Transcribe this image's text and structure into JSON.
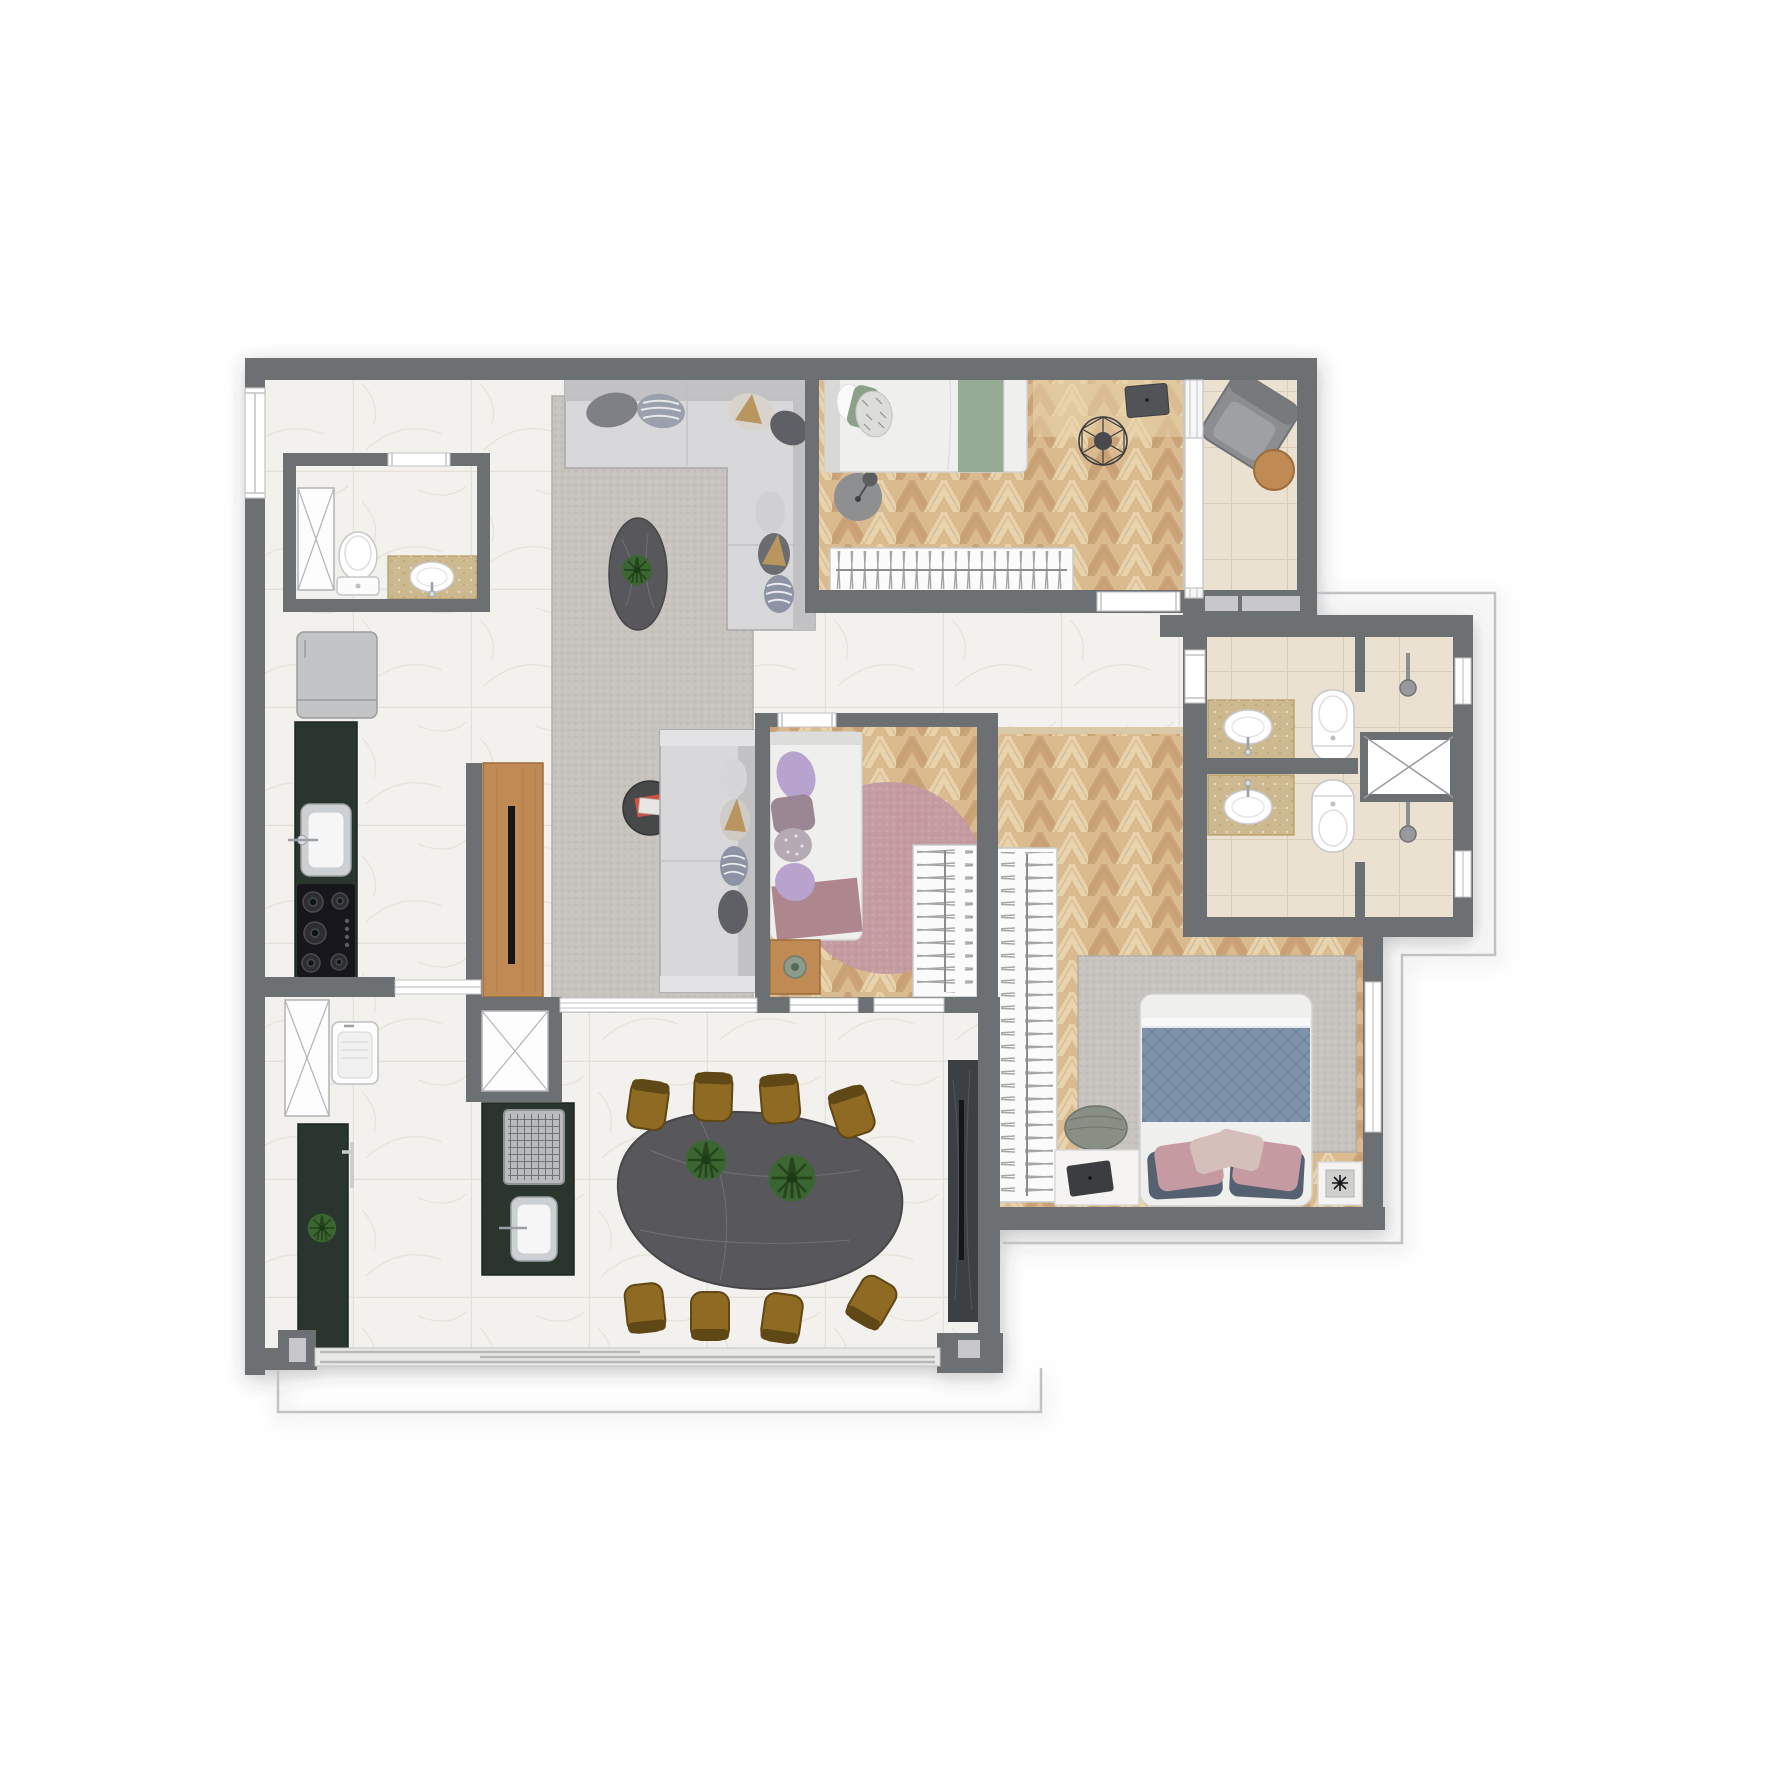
{
  "meta": {
    "title": "apartment-floor-plan",
    "kind": "architectural top-view render, no text labels",
    "background": "#ffffff"
  },
  "palette": {
    "wall": "#6d6f72",
    "wall_light": "#c7c7c9",
    "frame": "#c2c2c4",
    "marble": "#f3f1ed",
    "marble_line": "#e4dfd8",
    "wood": "#d9bb8f",
    "wood_dark": "#cba377",
    "wood_light": "#e8d3ac",
    "wood_seam": "#b8906a",
    "tile": "#ebe1d0",
    "tile_line": "#d9cdb7",
    "rug": "#c7c3be",
    "rug_edge": "#b2aea8",
    "sofa": "#d8d8da",
    "sofa_back": "#c2c2c5",
    "sofa_line": "#a8a8ab",
    "counter_green": "#2c362f",
    "counter_green_dark": "#1d2620",
    "steel": "#ccd0d2",
    "steel_dark": "#9aa0a3",
    "stone": "#58595b",
    "stone_line": "#707174",
    "gold": "#8e6b20",
    "gold_dark": "#5f4716",
    "plant": "#3b6631",
    "plant_dark": "#25451d",
    "bed_white": "#efefee",
    "bed_line": "#d2d2d0",
    "sage": "#95ab93",
    "quilt_blue": "#7e93a9",
    "quilt_line": "#5f7690",
    "navy": "#55616f",
    "pink": "#c59ba1",
    "blush": "#d4bfba",
    "pink_rug": "#c49aa2",
    "lilac": "#b7a3cd",
    "mauve": "#9b8793",
    "wood_furniture": "#c08a55",
    "wood_furniture_dark": "#9d6c38",
    "panel_dark": "#3c3f42",
    "tv_black": "#141517",
    "vanity_stone": "#cdb990",
    "vanity_stone_dark": "#b39a60",
    "chair_gray": "#8b8d90",
    "chair_gray_dark": "#6f7173",
    "wire": "#3a3b3d",
    "white": "#ffffff"
  },
  "rooms": [
    {
      "id": "entry-hall",
      "floor": "marble",
      "furniture": [
        "entry-door"
      ]
    },
    {
      "id": "guest-bathroom",
      "floor": "marble",
      "furniture": [
        "toilet",
        "vanity-sink",
        "shaft-closet"
      ]
    },
    {
      "id": "kitchen",
      "floor": "marble",
      "furniture": [
        "refrigerator",
        "green-counter",
        "kitchen-sink",
        "cooktop"
      ]
    },
    {
      "id": "laundry",
      "floor": "marble",
      "furniture": [
        "shaft-closet",
        "utility-sink",
        "green-counter",
        "plant",
        "counter-faucet"
      ]
    },
    {
      "id": "living-room",
      "floor": "marble",
      "furniture": [
        "area-rug",
        "l-sofa",
        "straight-sofa",
        "coffee-table",
        "magazine-table",
        "tv-wood-panel"
      ]
    },
    {
      "id": "dining-room",
      "floor": "marble",
      "furniture": [
        "dining-table",
        "dining-chairs-x8",
        "table-plants-x2",
        "grill-island",
        "island-sink",
        "service-shaft"
      ]
    },
    {
      "id": "bedroom-1",
      "floor": "chevron-wood",
      "furniture": [
        "single-bed",
        "round-rug",
        "floor-lamp",
        "hanger-wardrobe",
        "desk",
        "wire-chair"
      ]
    },
    {
      "id": "balcony",
      "floor": "beige-tile",
      "furniture": [
        "lounge-armchair",
        "round-side-table"
      ]
    },
    {
      "id": "bedroom-2",
      "floor": "chevron-wood",
      "furniture": [
        "single-bed",
        "round-pink-rug",
        "wood-nightstand",
        "plant",
        "hanger-wardrobe"
      ]
    },
    {
      "id": "bathroom-top",
      "floor": "beige-tile",
      "furniture": [
        "stone-vanity-sink",
        "toilet",
        "shower-head",
        "shaft-box",
        "window"
      ]
    },
    {
      "id": "bathroom-bottom",
      "floor": "beige-tile",
      "furniture": [
        "stone-vanity-sink",
        "toilet",
        "shower-head",
        "window"
      ]
    },
    {
      "id": "master-suite",
      "floor": "chevron-wood",
      "furniture": [
        "open-closet",
        "double-bed",
        "area-rug",
        "pouf",
        "bench-laptop",
        "nightstand-plant",
        "dark-tv-panel",
        "window"
      ]
    }
  ],
  "openings": [
    "entry-window",
    "bedroom-1-door",
    "bedroom-2-door",
    "bedroom-2-windows",
    "living-glass-partition",
    "balcony-glass-partition",
    "bathroom-door",
    "bathroom-windows",
    "master-window",
    "terrace-sliding-door",
    "kitchen-sliding-door",
    "guest-bath-door"
  ],
  "outline_color": "#c9c9c9",
  "counts": {
    "dining_chairs": 8,
    "bathroom_sinks": 3,
    "toilets": 3,
    "beds": 3,
    "sofas": 2
  }
}
